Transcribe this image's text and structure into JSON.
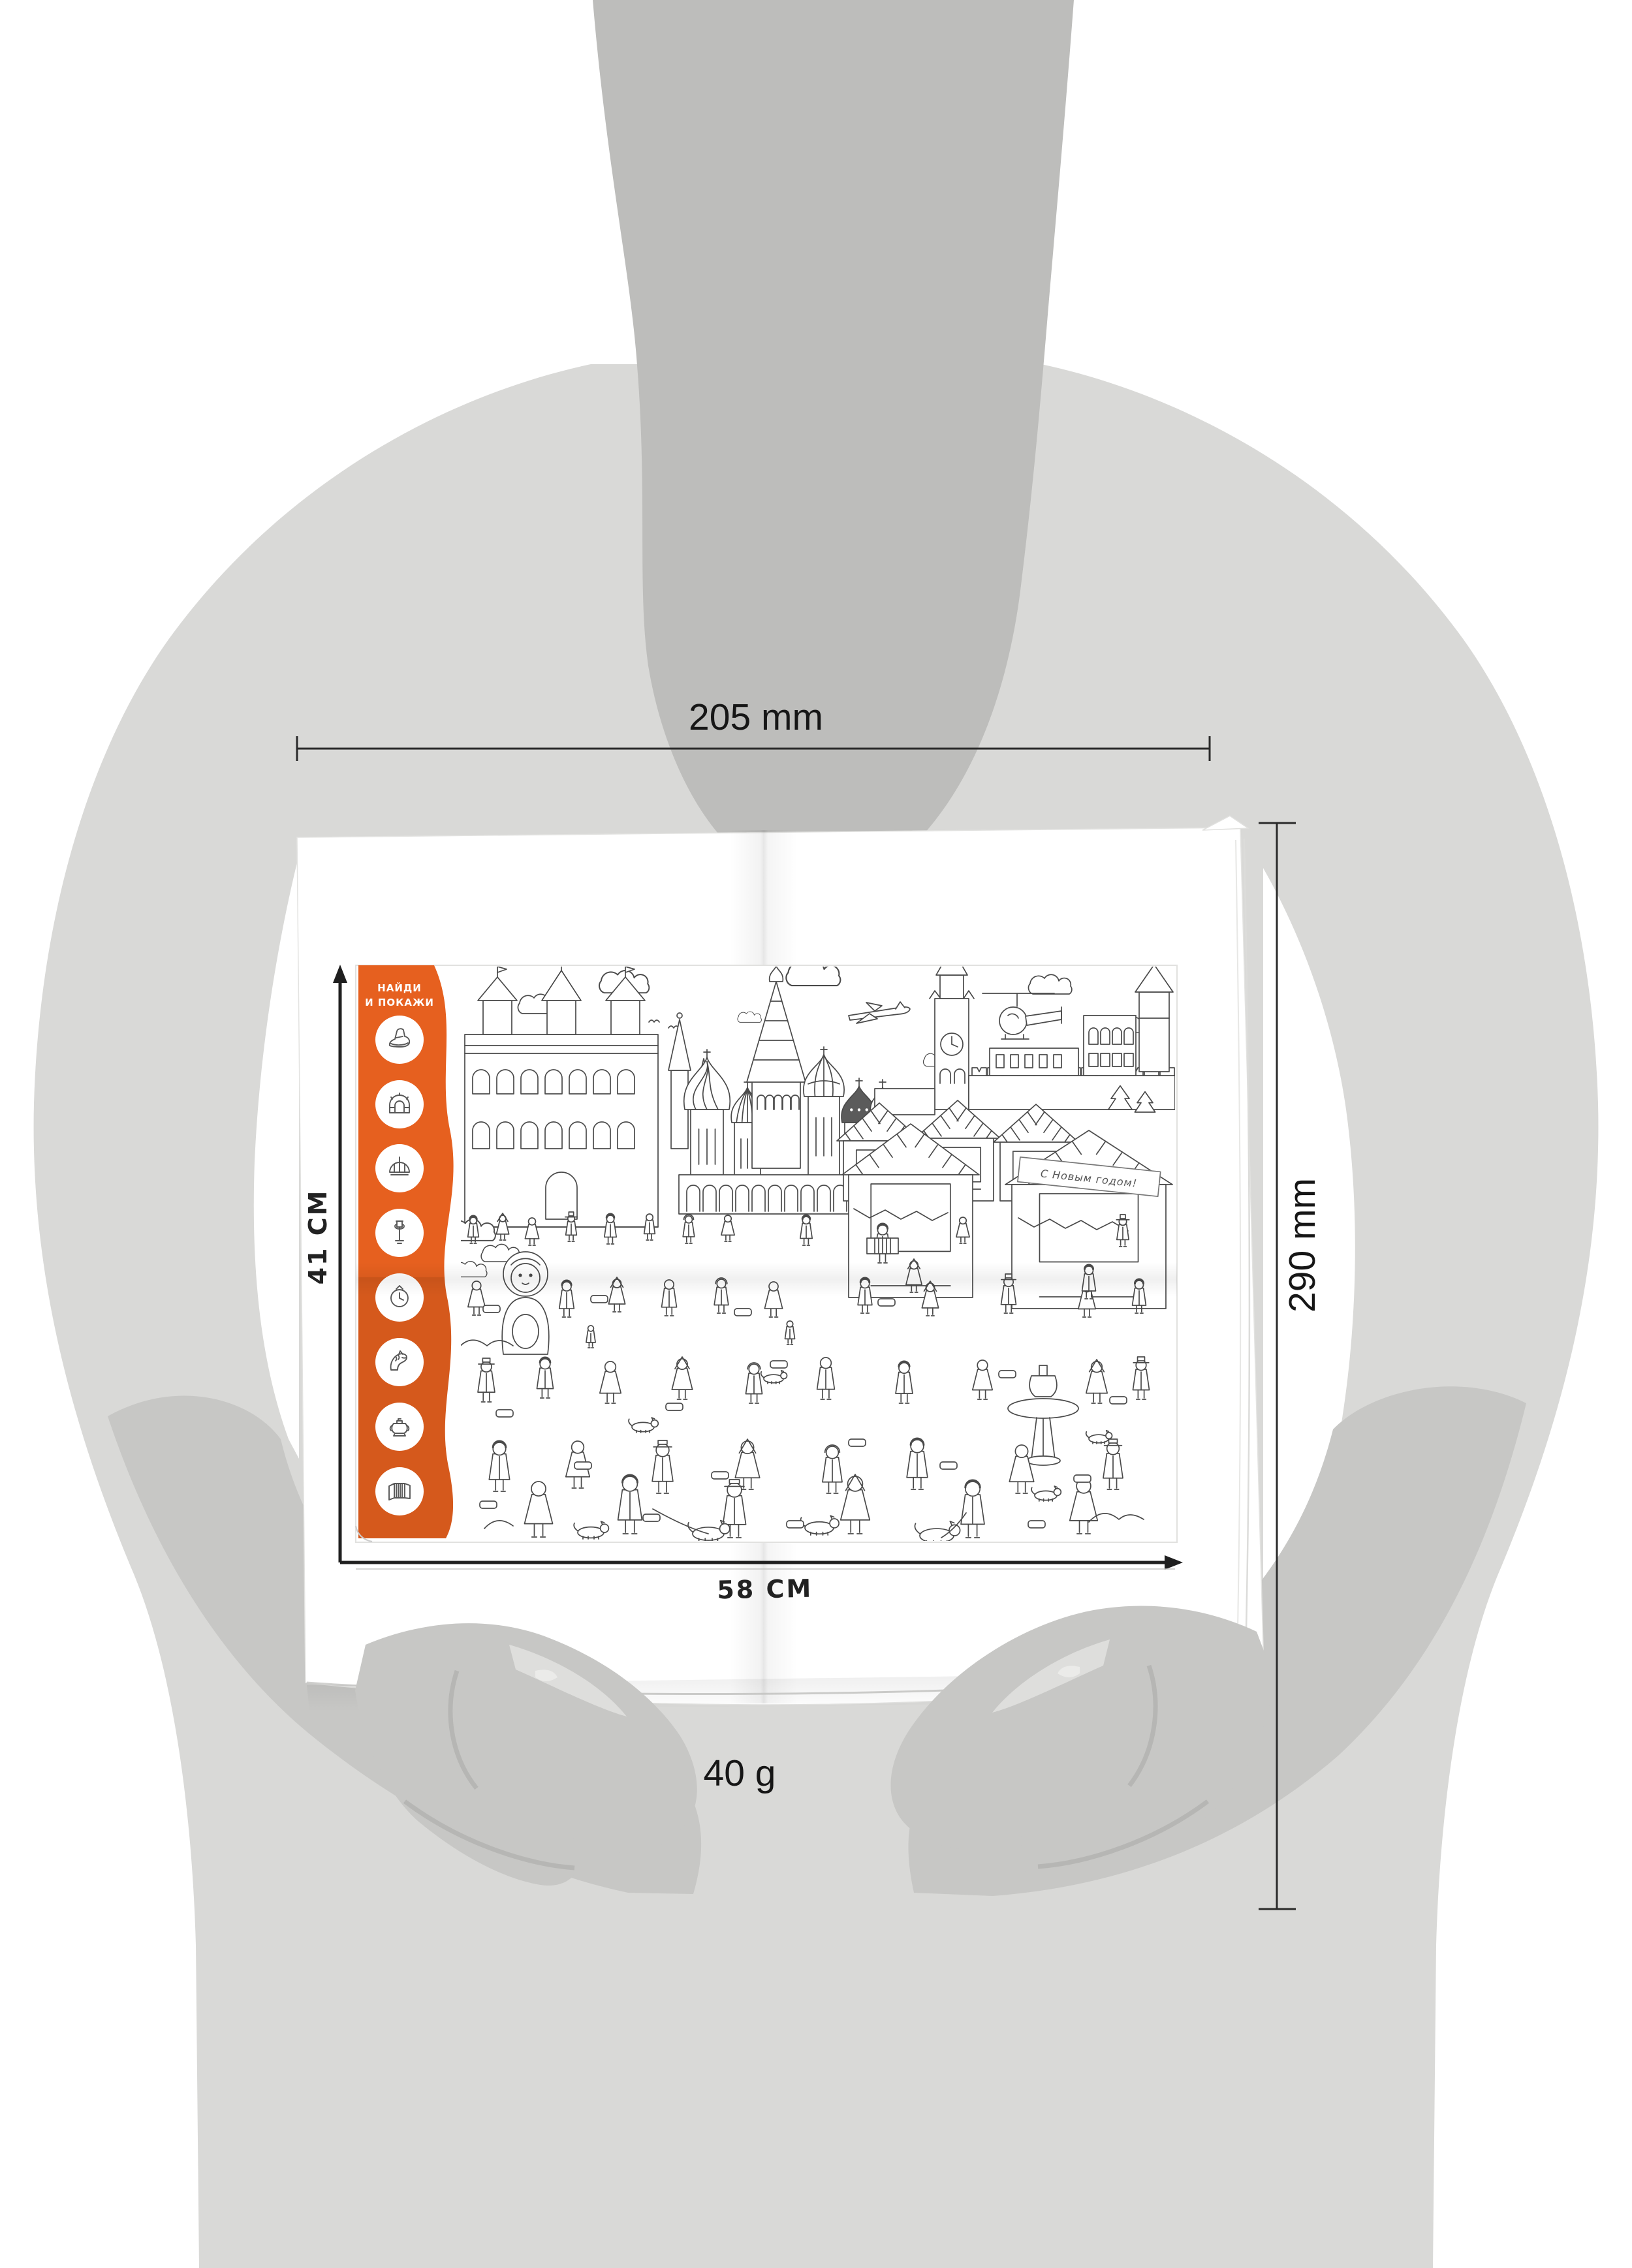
{
  "annotations": {
    "width_label": "205 mm",
    "height_label": "290 mm",
    "weight_label": "40 g"
  },
  "poster": {
    "sidebar_title_line1": "НАЙДИ",
    "sidebar_title_line2": "И ПОКАЖИ",
    "height_label": "41 СМ",
    "width_label": "58 СМ",
    "banner_text": "С Новым годом!",
    "find_icons": [
      {
        "name": "felt-boot-icon"
      },
      {
        "name": "arch-icon"
      },
      {
        "name": "dome-icon"
      },
      {
        "name": "street-lamp-icon"
      },
      {
        "name": "clock-icon"
      },
      {
        "name": "horse-icon"
      },
      {
        "name": "samovar-icon"
      },
      {
        "name": "accordion-icon"
      }
    ]
  },
  "colors": {
    "background": "#ffffff",
    "body": "#d9d9d7",
    "neck": "#bdbdbb",
    "arm": "#c7c7c5",
    "arm_shadow": "#b1b1af",
    "arm_highlight": "#dededc",
    "accent": "#e6601f",
    "accent_shade": "#b34a15",
    "line_art": "#4a4a4a",
    "annotation": "#1c1c1c"
  }
}
